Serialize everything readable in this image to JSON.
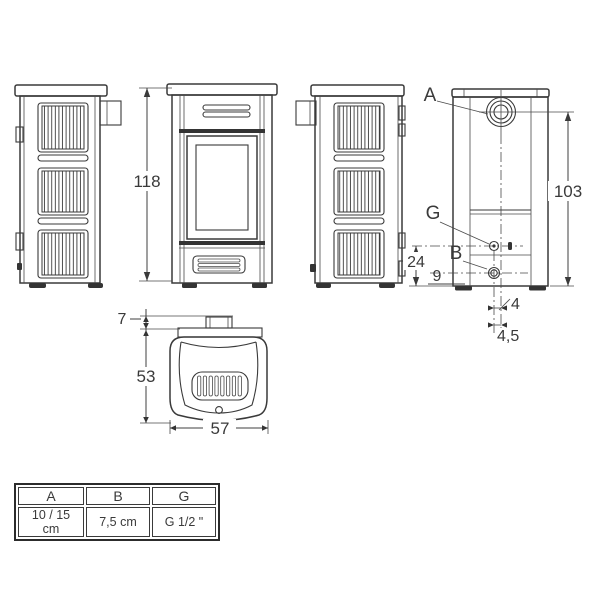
{
  "drawing": {
    "overall_height": "118",
    "rear_flue_height": "103",
    "g_fitting_height": "24",
    "b_fitting_height": "9",
    "b_offset_upper": "4",
    "b_offset_lower": "4,5",
    "flue_protrusion": "7",
    "depth": "53",
    "width": "57",
    "label_flue": "A",
    "label_g_fitting": "G",
    "label_b_fitting": "B"
  },
  "table": {
    "headers": [
      "A",
      "B",
      "G"
    ],
    "values": [
      "10 / 15 cm",
      "7,5 cm",
      "G 1/2 \""
    ]
  },
  "colors": {
    "line": "#3a3a3a",
    "background": "#ffffff"
  }
}
